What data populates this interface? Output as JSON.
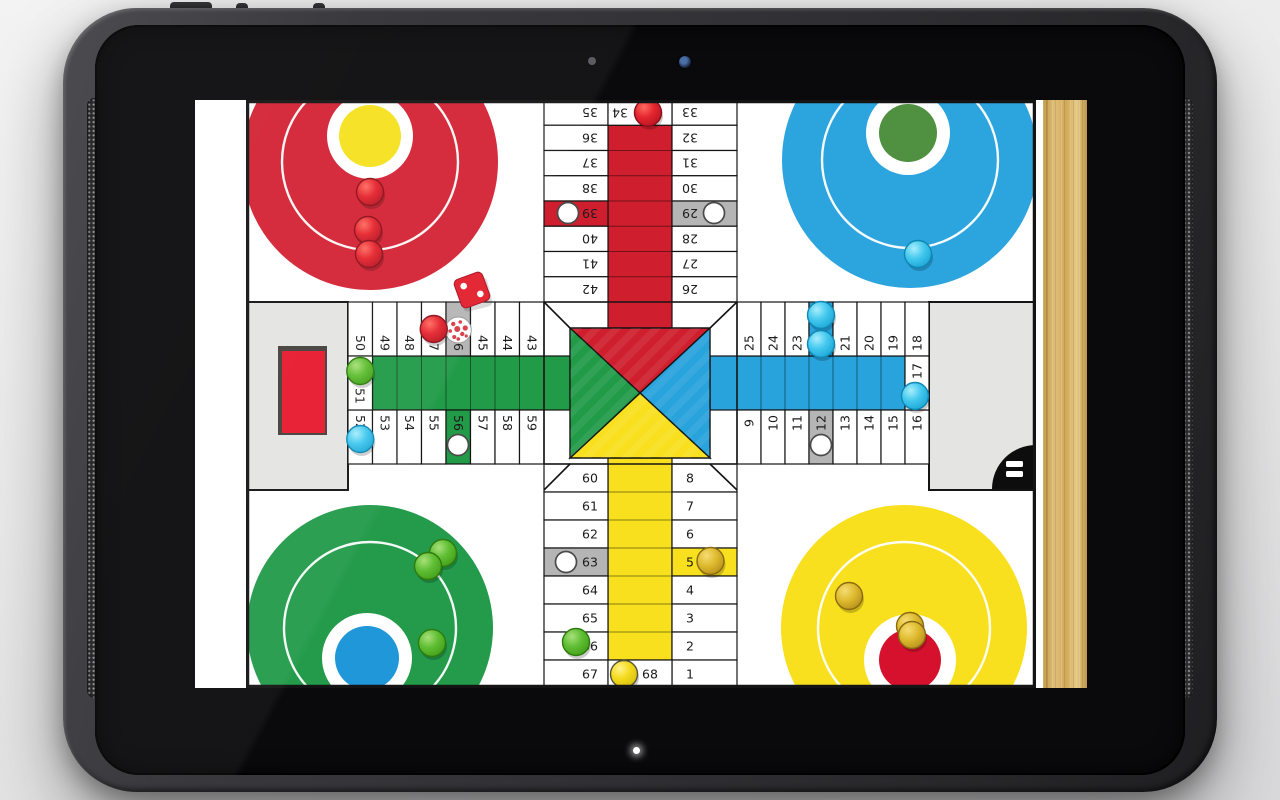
{
  "device": {
    "front_camera": "camera-lens-icon",
    "light_sensor": "sensor-dot-icon",
    "notification_led": "led-icon",
    "speakers": [
      "speaker-grille-left",
      "speaker-grille-right"
    ]
  },
  "board": {
    "arms": {
      "top": {
        "left_col": [
          "35",
          "36",
          "37",
          "38",
          "39",
          "40",
          "41",
          "42"
        ],
        "right_col": [
          "33",
          "32",
          "31",
          "30",
          "29",
          "28",
          "27",
          "26"
        ],
        "entry_cell": "34"
      },
      "bottom": {
        "left_col": [
          "60",
          "61",
          "62",
          "63",
          "64",
          "65",
          "66",
          "67"
        ],
        "right_col": [
          "8",
          "7",
          "6",
          "5",
          "4",
          "3",
          "2",
          "1"
        ],
        "entry_cell": "68"
      },
      "left": {
        "top_row": [
          "50",
          "49",
          "48",
          "47",
          "46",
          "45",
          "44",
          "43"
        ],
        "bottom_row": [
          "52",
          "53",
          "54",
          "55",
          "56",
          "57",
          "58",
          "59"
        ],
        "entry_cell": "51"
      },
      "right": {
        "top_row": [
          "25",
          "24",
          "23",
          "22",
          "21",
          "20",
          "19",
          "18"
        ],
        "bottom_row": [
          "9",
          "10",
          "11",
          "12",
          "13",
          "14",
          "15",
          "16"
        ],
        "entry_cell": "17"
      }
    },
    "special_cells": {
      "5": "yellow",
      "22": "blue",
      "39": "red",
      "56": "green",
      "12": "gray",
      "29": "gray",
      "46": "gray",
      "63": "gray"
    },
    "safe_markers": [
      12,
      29,
      39,
      56,
      63
    ],
    "colors": {
      "red": "#cf1f2e",
      "blue": "#28a3dc",
      "green": "#219b48",
      "yellow": "#f8e01e",
      "gray_cell": "#b5b5b5",
      "panel": "#e4e4e2",
      "board_line": "#141414",
      "home_red": "#d32334",
      "home_blue": "#2ca4de",
      "home_green": "#239b4a",
      "home_yellow": "#f9e01e",
      "home_dot_red": "#d5112d",
      "home_dot_blue": "#1f97d8",
      "home_dot_green": "#4f9140",
      "home_dot_yellow": "#f5e11f",
      "tray_red": "#e8192e",
      "menu_black": "#0d0d0d"
    },
    "pieces_on_cells": [
      {
        "cell": "34",
        "color": "red",
        "dx": 8,
        "dy": 0
      },
      {
        "cell": "47",
        "color": "red",
        "dx": 0,
        "dy": 0
      },
      {
        "cell": "22",
        "color": "cyan",
        "dx": 0,
        "dy": -14
      },
      {
        "cell": "22",
        "color": "cyan",
        "dx": 0,
        "dy": 15
      },
      {
        "cell": "17",
        "color": "cyan",
        "dx": -2,
        "dy": 13
      },
      {
        "cell": "52",
        "color": "cyan",
        "dx": 0,
        "dy": 2
      },
      {
        "cell": "51",
        "color": "green",
        "dx": 0,
        "dy": -12
      },
      {
        "cell": "66",
        "color": "green",
        "dx": 0,
        "dy": -4
      },
      {
        "cell": "5",
        "color": "gold",
        "dx": 6,
        "dy": -1
      },
      {
        "cell": "68",
        "color": "yellow",
        "dx": -16,
        "dy": 0
      }
    ],
    "pieces_in_homes": [
      {
        "home": "red",
        "color": "red",
        "x": 124,
        "y": 92
      },
      {
        "home": "red",
        "color": "red",
        "x": 122,
        "y": 130
      },
      {
        "home": "red",
        "color": "red",
        "x": 123,
        "y": 154
      },
      {
        "home": "blue",
        "color": "cyan",
        "x": 672,
        "y": 154
      },
      {
        "home": "green",
        "color": "green",
        "x": 197,
        "y": 453
      },
      {
        "home": "green",
        "color": "green",
        "x": 182,
        "y": 466
      },
      {
        "home": "green",
        "color": "green",
        "x": 186,
        "y": 543
      },
      {
        "home": "yellow",
        "color": "gold",
        "x": 603,
        "y": 496
      },
      {
        "home": "yellow",
        "color": "gold",
        "x": 664,
        "y": 526
      },
      {
        "home": "yellow",
        "color": "gold",
        "x": 666,
        "y": 535
      }
    ],
    "die": {
      "face": 2,
      "color": "red"
    },
    "rolling_die_cell": "46",
    "menu_button": {
      "icon": "menu-icon"
    },
    "dice_tray": {
      "color": "red"
    }
  }
}
